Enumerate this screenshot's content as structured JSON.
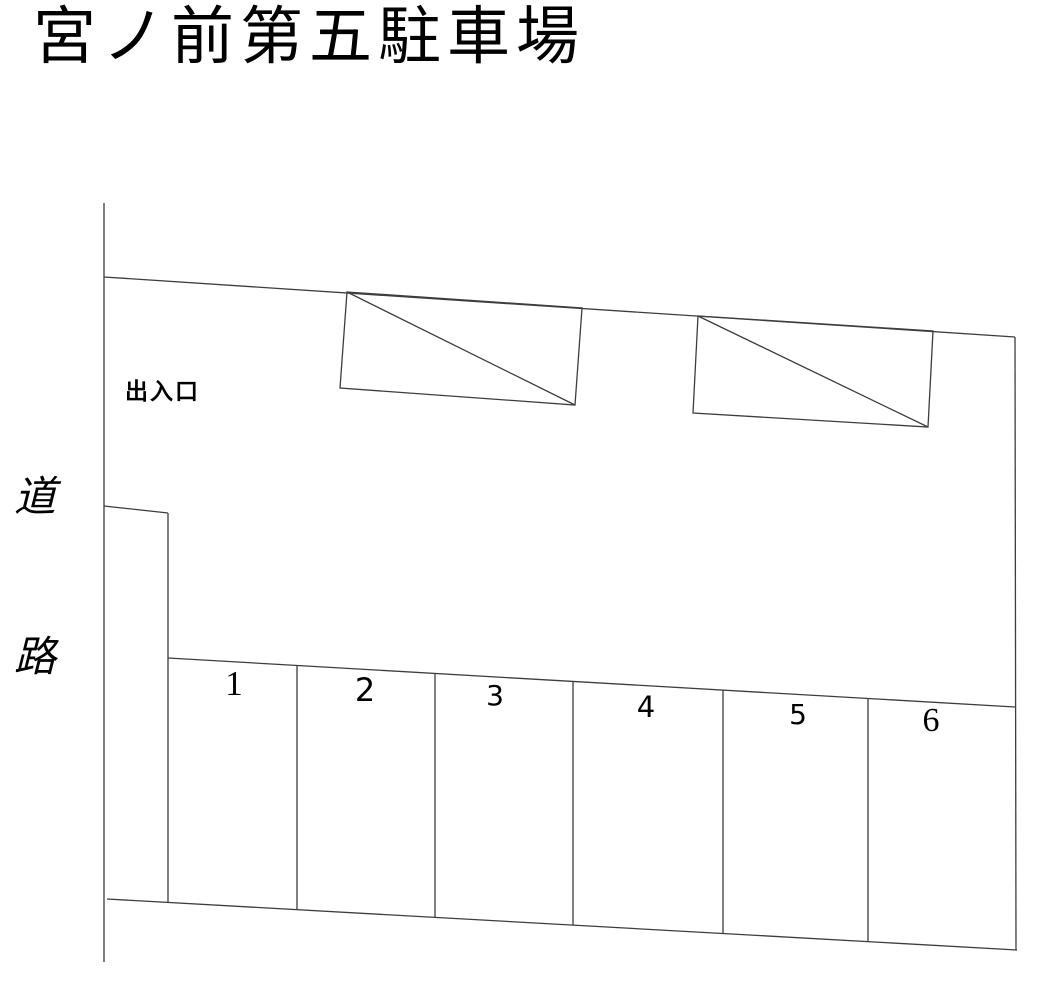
{
  "title": "宮ノ前第五駐車場",
  "road": {
    "label_top_char": "道",
    "label_bottom_char": "路"
  },
  "entrance": {
    "label": "出入口"
  },
  "stalls": [
    {
      "number": "1"
    },
    {
      "number": "2"
    },
    {
      "number": "3"
    },
    {
      "number": "4"
    },
    {
      "number": "5"
    },
    {
      "number": "6"
    }
  ],
  "colors": {
    "line": "#3d3d3d",
    "text": "#000000",
    "background": "#ffffff"
  }
}
